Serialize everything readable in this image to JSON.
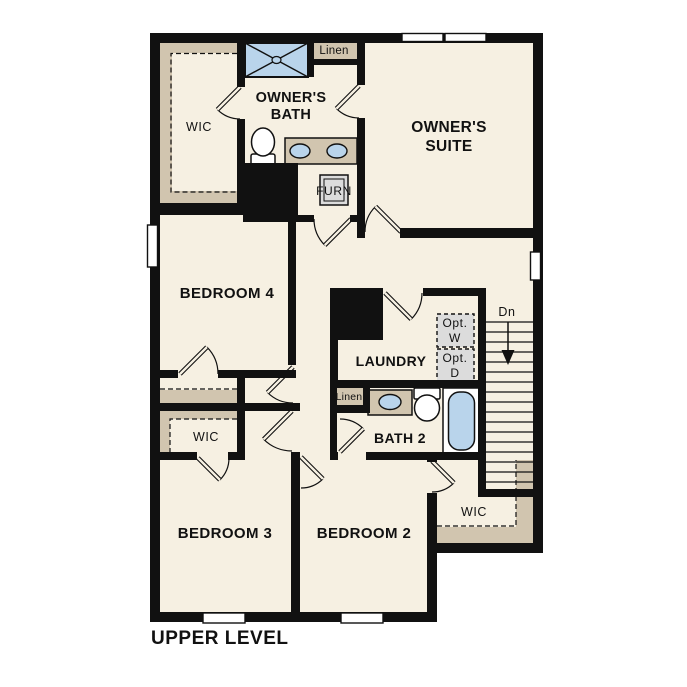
{
  "floor_plan": {
    "level_label": "UPPER LEVEL",
    "colors": {
      "wall": "#111111",
      "floor": "#f6f0e2",
      "closet_tan": "#d1c5af",
      "fixture_blue": "#b9d4eb",
      "appliance_grey": "#dcdcdc",
      "window_white": "#ffffff"
    },
    "labels": {
      "owners_wic": "WIC",
      "owners_bath": "OWNER'S BATH",
      "linen_upper": "Linen",
      "owners_suite": "OWNER'S SUITE",
      "furnace": "FURN",
      "bedroom_4": "BEDROOM 4",
      "laundry": "LAUNDRY",
      "optional_washer": "Opt. W",
      "optional_dryer": "Opt. D",
      "stairs_down": "Dn",
      "bath2_linen": "Linen",
      "bath_2": "BATH 2",
      "bedroom3_wic": "WIC",
      "bedroom_3": "BEDROOM 3",
      "bedroom_2": "BEDROOM 2",
      "bedroom2_wic": "WIC"
    }
  }
}
